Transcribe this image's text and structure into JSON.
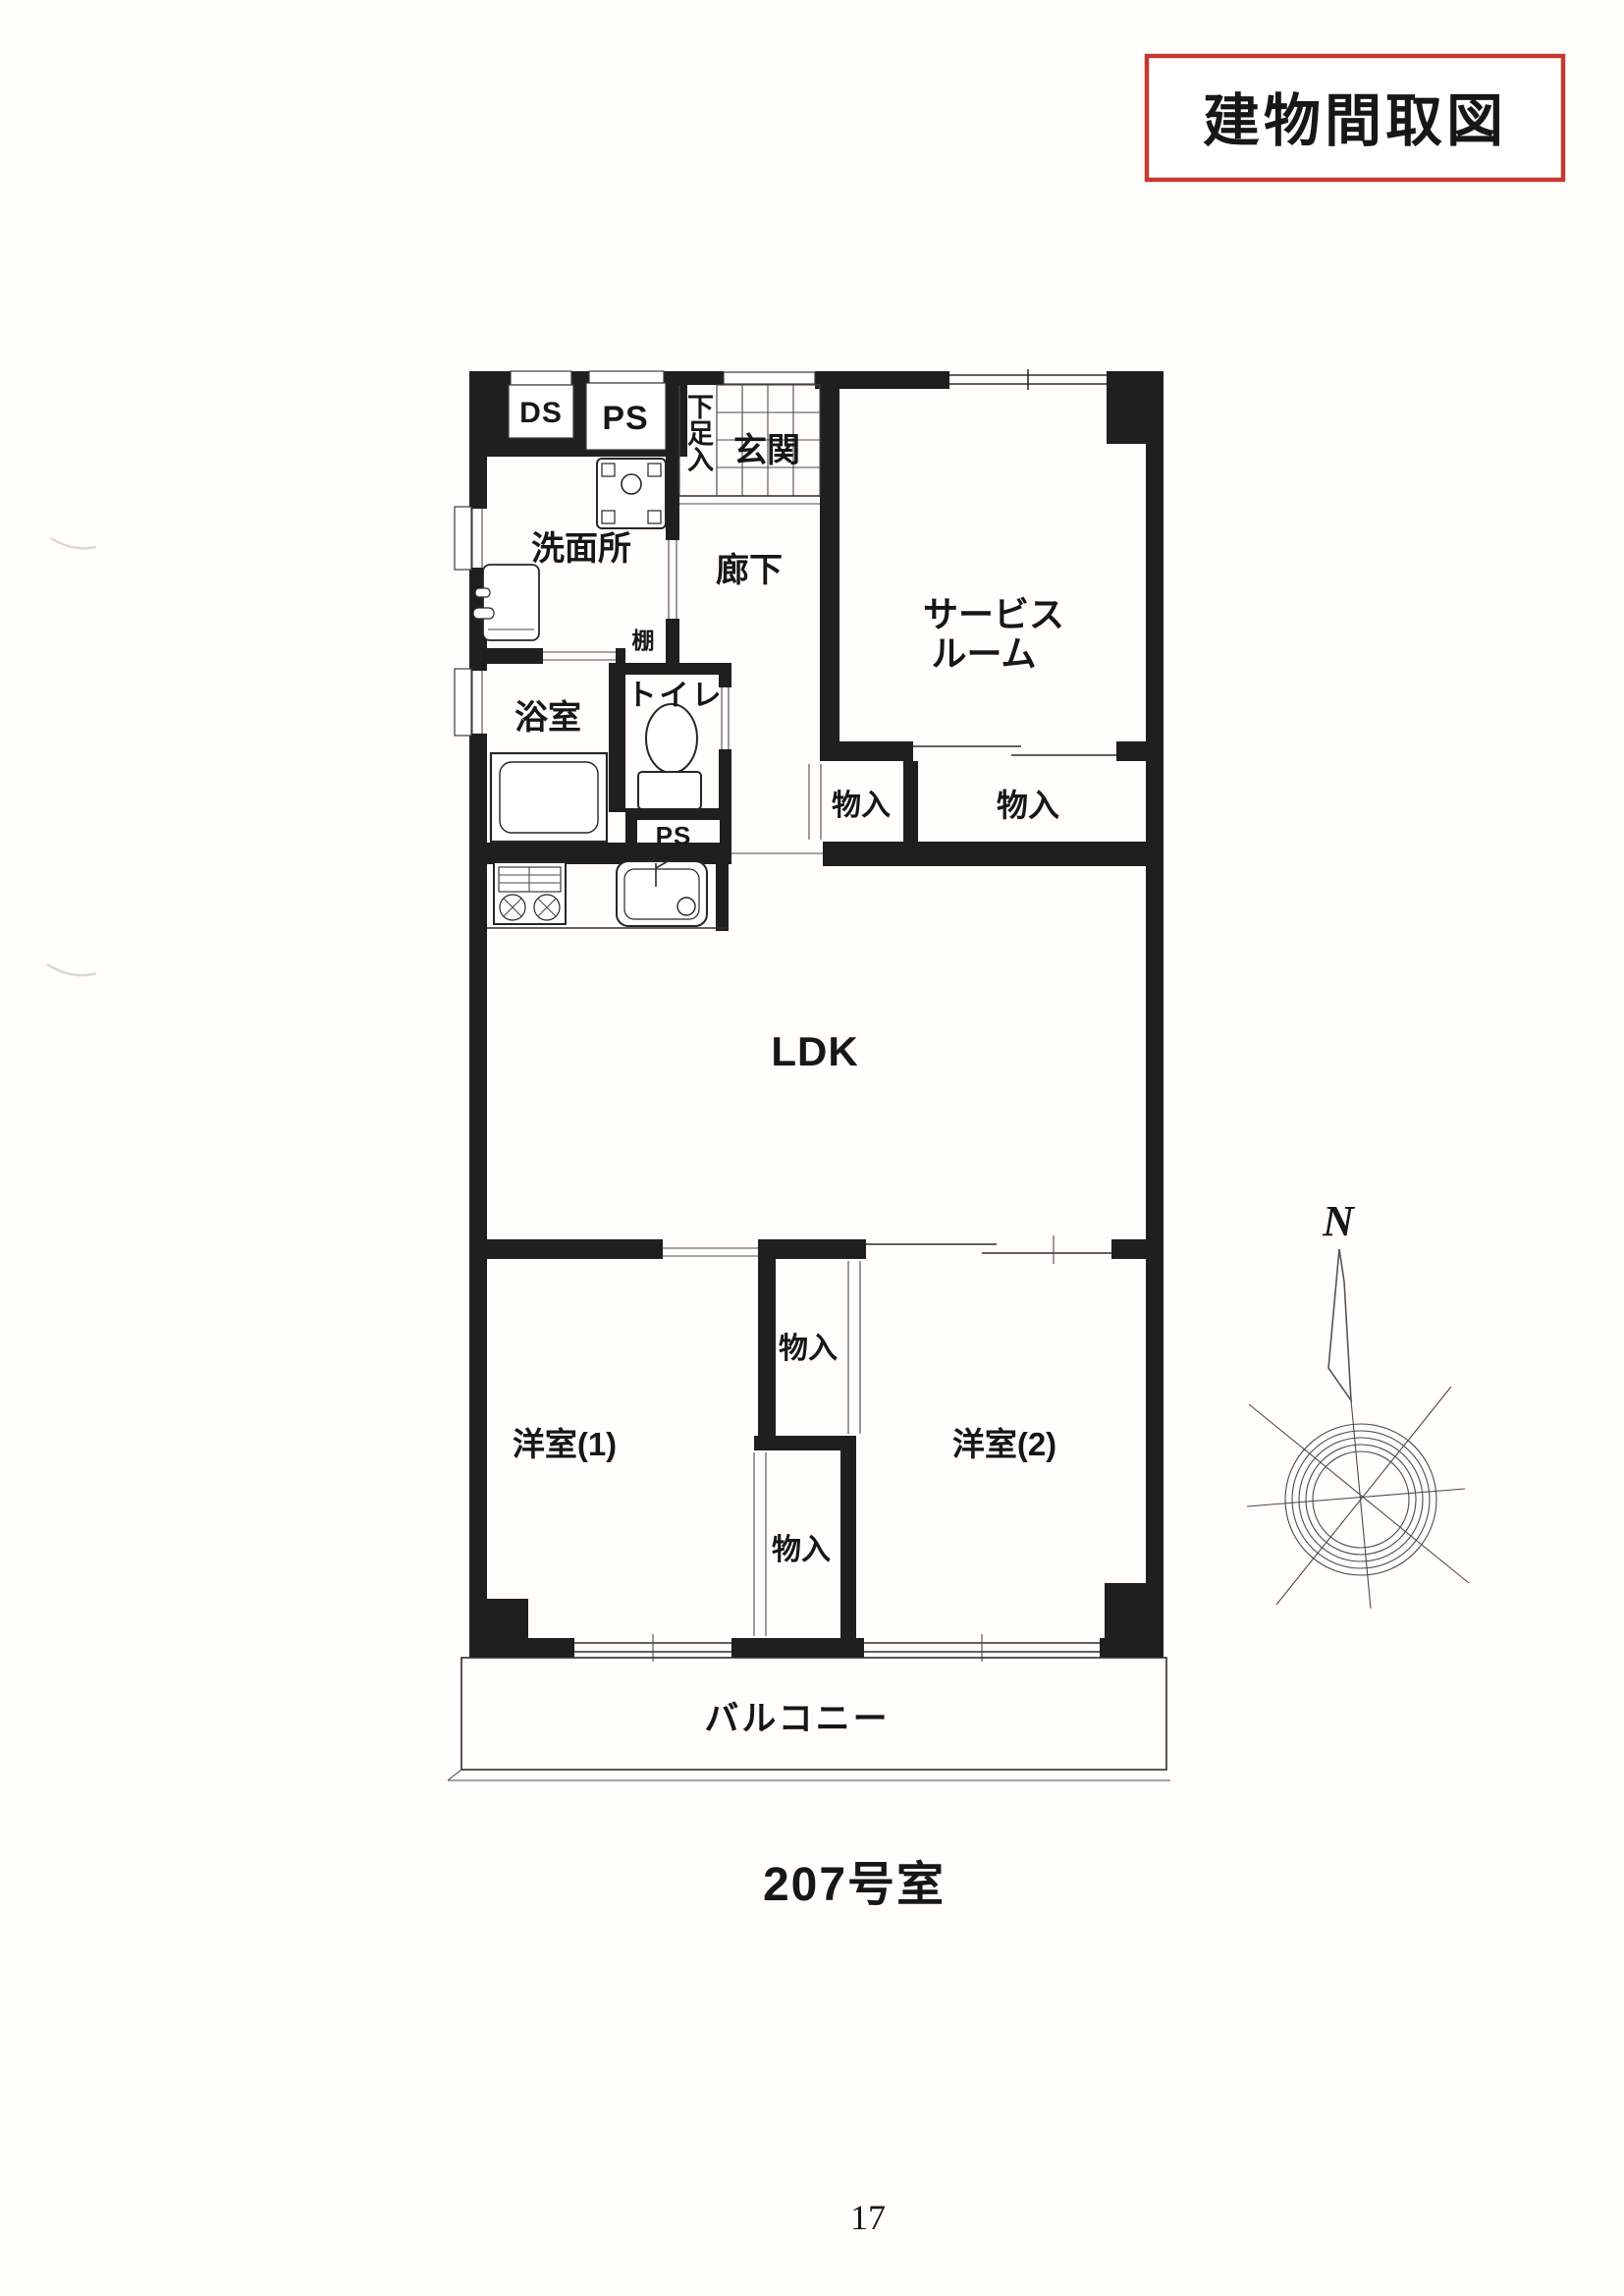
{
  "title_badge": {
    "label": "建物間取図"
  },
  "unit_label": "207号室",
  "page_number": "17",
  "compass": {
    "north_label": "N"
  },
  "plan": {
    "labels": {
      "ds": "DS",
      "ps_top": "PS",
      "shoe_cabinet": "下足入",
      "entrance": "玄関",
      "washroom": "洗面所",
      "hallway": "廊下",
      "service_room_line1": "サービス",
      "service_room_line2": "ルーム",
      "shelf": "棚",
      "toilet": "トイレ",
      "bathroom": "浴室",
      "ps_mid": "PS",
      "storage_left": "物入",
      "storage_right": "物入",
      "ldk": "LDK",
      "bedroom1": "洋室(1)",
      "storage_upper": "物入",
      "storage_lower": "物入",
      "bedroom2": "洋室(2)",
      "balcony": "バルコニー"
    }
  },
  "colors": {
    "wall": "#1f1f1f",
    "accent_red": "#c23b33",
    "line": "#2d2d2d"
  }
}
